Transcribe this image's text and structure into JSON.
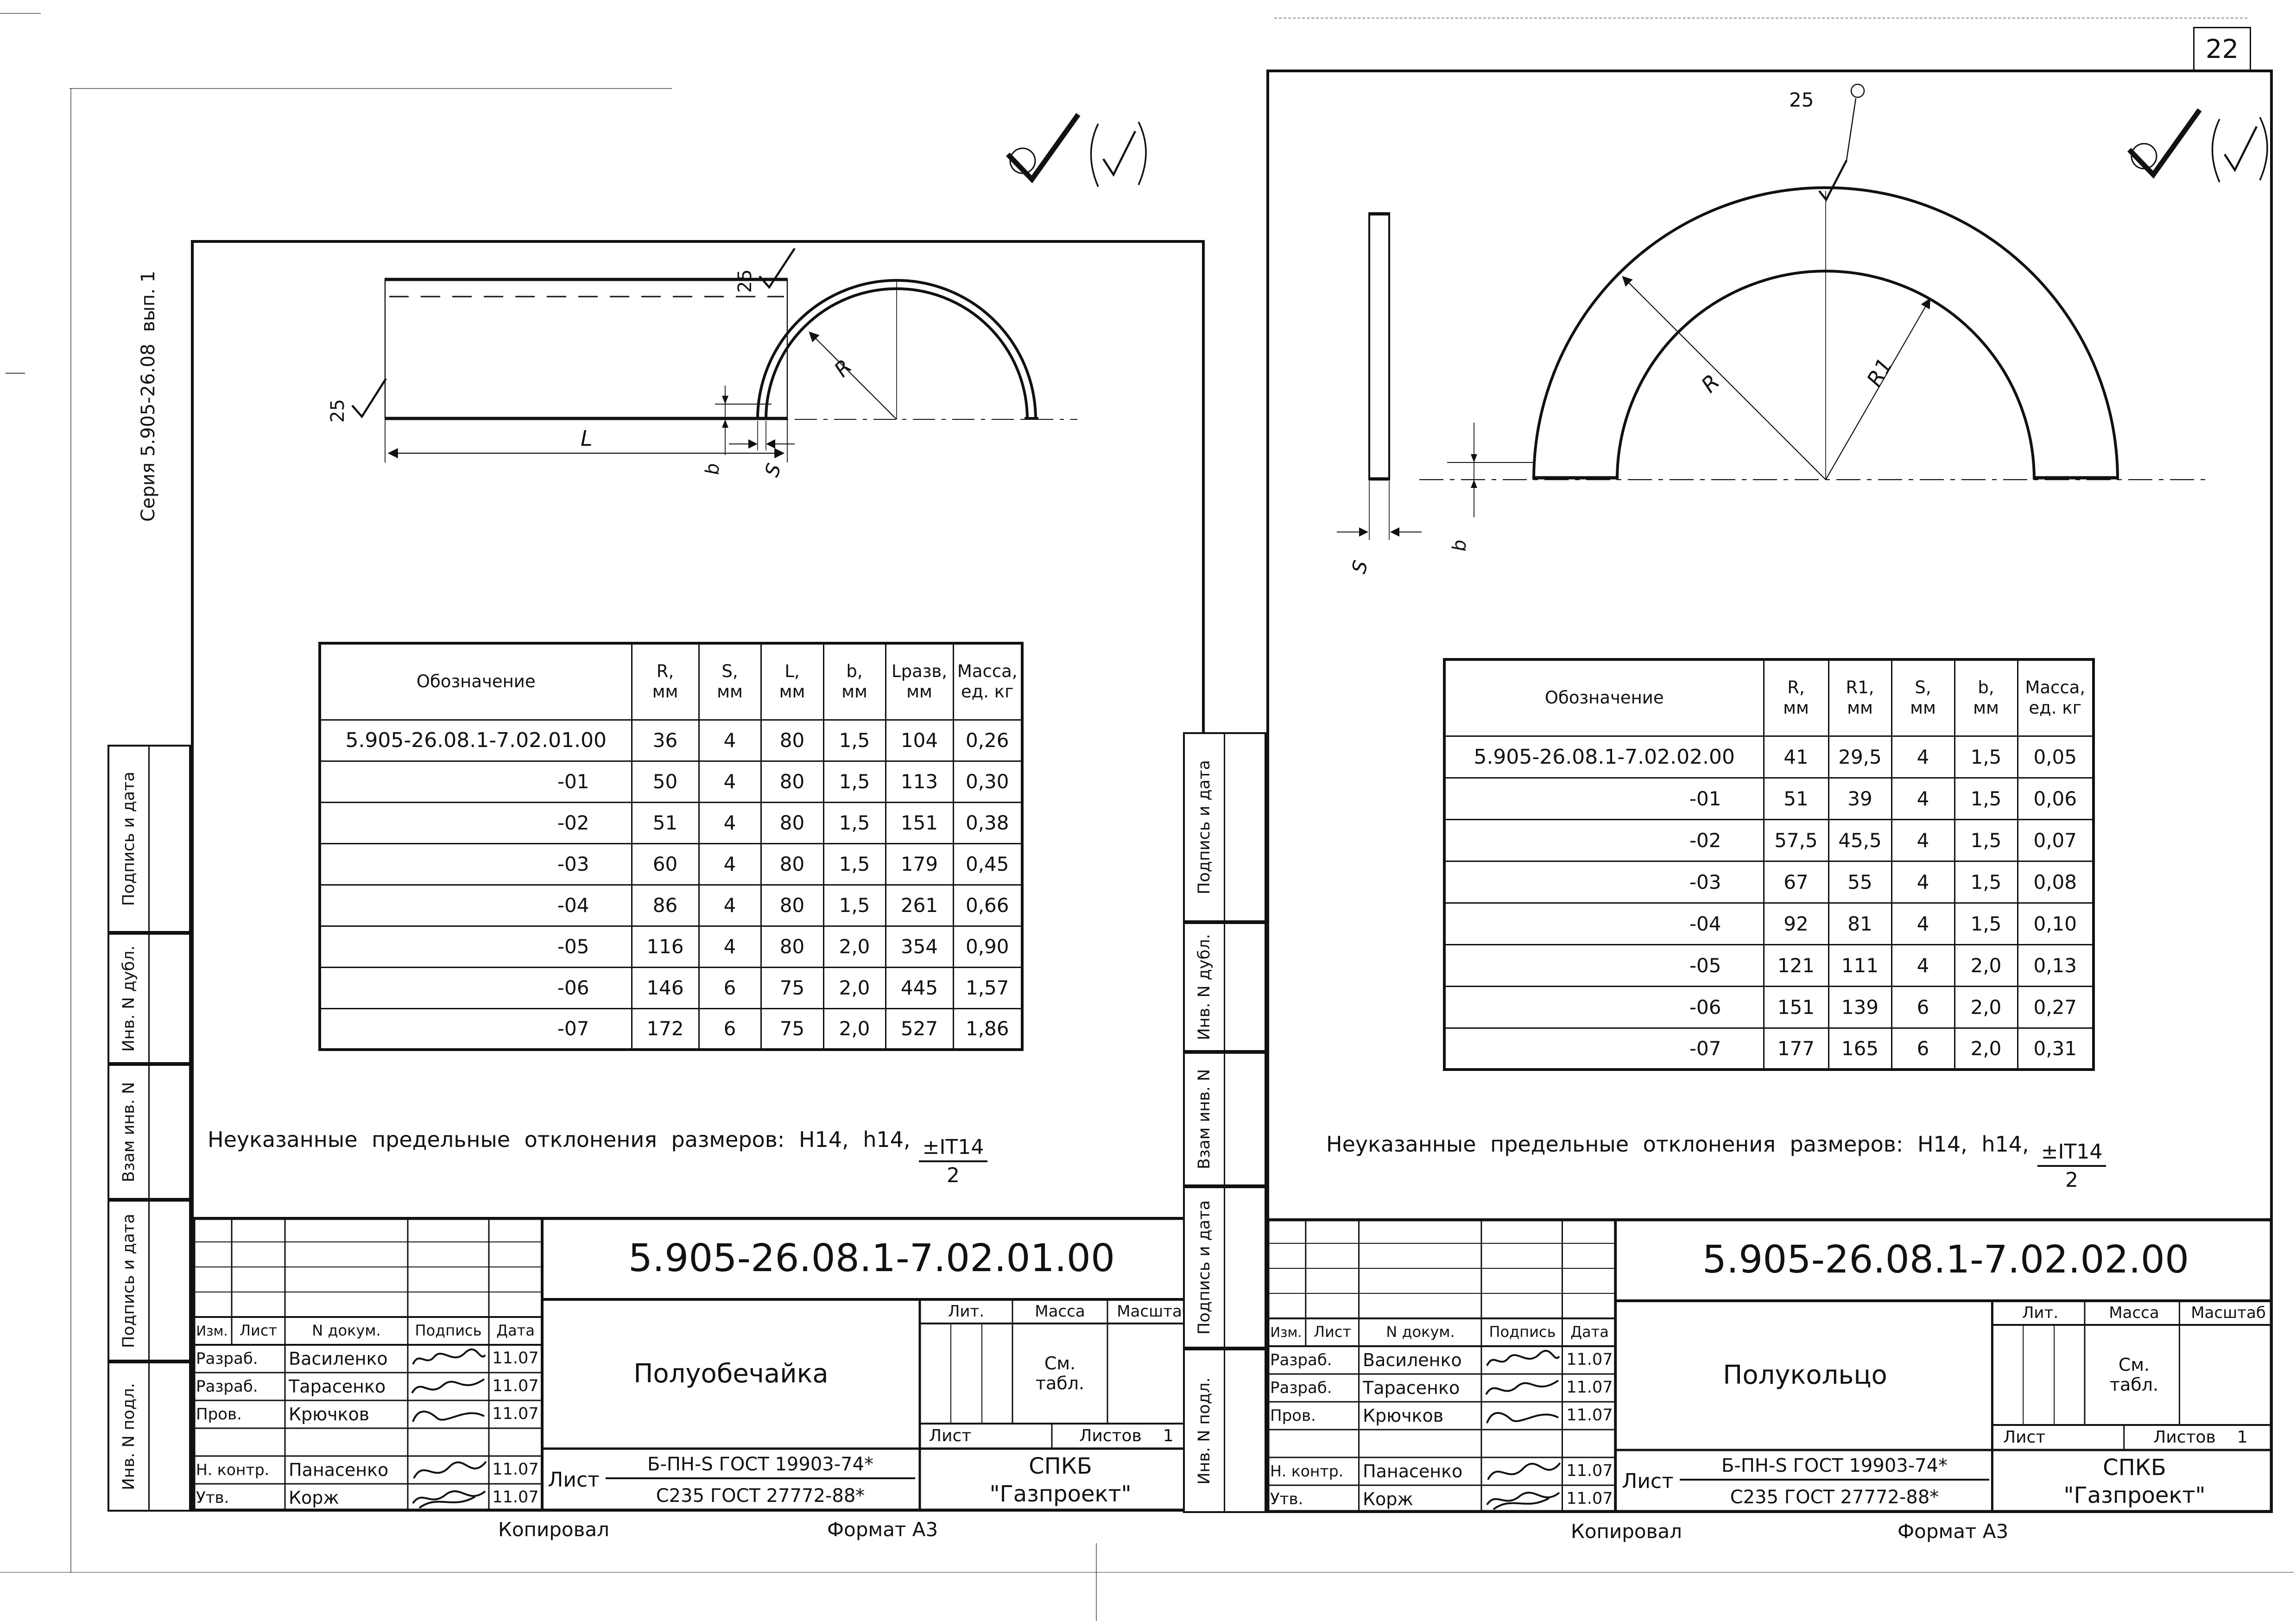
{
  "page": {
    "sheet_number": "22",
    "footer_kopiroval": "Копировал",
    "footer_format": "Формат А3"
  },
  "left_sheet": {
    "series_label": "Серия 5.905-26.08  вып. 1",
    "margin_labels": [
      "Подпись и дата",
      "Инв. N дубл.",
      "Взам инв. N",
      "Подпись и дата",
      "Инв. N подл."
    ],
    "drawing": {
      "rough_top": "25",
      "rough_left": "25",
      "dim_L": "L",
      "dim_R": "R",
      "dim_b": "b",
      "dim_S": "S"
    },
    "table": {
      "headers": [
        "Обозначение",
        "R,\nмм",
        "S,\nмм",
        "L,\nмм",
        "b,\nмм",
        "Lразв,\nмм",
        "Масса,\nед. кг"
      ],
      "rows": [
        [
          "5.905-26.08.1-7.02.01.00",
          "36",
          "4",
          "80",
          "1,5",
          "104",
          "0,26"
        ],
        [
          "-01",
          "50",
          "4",
          "80",
          "1,5",
          "113",
          "0,30"
        ],
        [
          "-02",
          "51",
          "4",
          "80",
          "1,5",
          "151",
          "0,38"
        ],
        [
          "-03",
          "60",
          "4",
          "80",
          "1,5",
          "179",
          "0,45"
        ],
        [
          "-04",
          "86",
          "4",
          "80",
          "1,5",
          "261",
          "0,66"
        ],
        [
          "-05",
          "116",
          "4",
          "80",
          "2,0",
          "354",
          "0,90"
        ],
        [
          "-06",
          "146",
          "6",
          "75",
          "2,0",
          "445",
          "1,57"
        ],
        [
          "-07",
          "172",
          "6",
          "75",
          "2,0",
          "527",
          "1,86"
        ]
      ]
    },
    "note": {
      "text": "Неуказанные предельные отклонения размеров: H14, h14,",
      "frac_num": "±IT14",
      "frac_den": "2"
    },
    "title_block": {
      "doc_number": "5.905-26.08.1-7.02.01.00",
      "part_name": "Полуобечайка",
      "col_izm": "Изм.",
      "col_list": "Лист",
      "col_dokum": "N докум.",
      "col_podpis": "Подпись",
      "col_data": "Дата",
      "people": [
        {
          "role": "Разраб.",
          "name": "Василенко",
          "date": "11.07"
        },
        {
          "role": "Разраб.",
          "name": "Тарасенко",
          "date": "11.07"
        },
        {
          "role": "Пров.",
          "name": "Крючков",
          "date": "11.07"
        },
        {
          "role": "",
          "name": "",
          "date": ""
        },
        {
          "role": "Н. контр.",
          "name": "Панасенко",
          "date": "11.07"
        },
        {
          "role": "Утв.",
          "name": "Корж",
          "date": "11.07"
        }
      ],
      "lit_label": "Лит.",
      "massa_label": "Масса",
      "masshtab_label": "Масштаб",
      "massa_value": "См.\nтабл.",
      "list_label": "Лист",
      "listov_label": "Листов",
      "listov_value": "1",
      "material_prefix": "Лист",
      "material_top": "Б-ПН-S ГОСТ 19903-74*",
      "material_bottom": "С235 ГОСТ 27772-88*",
      "org": "СПКБ\n\"Газпроект\""
    },
    "footer_kopiroval": "Копировал",
    "footer_format": "Формат А3"
  },
  "right_sheet": {
    "margin_labels": [
      "Подпись и дата",
      "Инв. N дубл.",
      "Взам инв. N",
      "Подпись и дата",
      "Инв. N подл."
    ],
    "drawing": {
      "rough_apex": "25",
      "dim_R": "R",
      "dim_R1": "R1",
      "dim_b": "b",
      "dim_S": "S"
    },
    "table": {
      "headers": [
        "Обозначение",
        "R,\nмм",
        "R1,\nмм",
        "S,\nмм",
        "b,\nмм",
        "Масса,\nед. кг"
      ],
      "rows": [
        [
          "5.905-26.08.1-7.02.02.00",
          "41",
          "29,5",
          "4",
          "1,5",
          "0,05"
        ],
        [
          "-01",
          "51",
          "39",
          "4",
          "1,5",
          "0,06"
        ],
        [
          "-02",
          "57,5",
          "45,5",
          "4",
          "1,5",
          "0,07"
        ],
        [
          "-03",
          "67",
          "55",
          "4",
          "1,5",
          "0,08"
        ],
        [
          "-04",
          "92",
          "81",
          "4",
          "1,5",
          "0,10"
        ],
        [
          "-05",
          "121",
          "111",
          "4",
          "2,0",
          "0,13"
        ],
        [
          "-06",
          "151",
          "139",
          "6",
          "2,0",
          "0,27"
        ],
        [
          "-07",
          "177",
          "165",
          "6",
          "2,0",
          "0,31"
        ]
      ]
    },
    "note": {
      "text": "Неуказанные предельные отклонения размеров: H14, h14,",
      "frac_num": "±IT14",
      "frac_den": "2"
    },
    "title_block": {
      "doc_number": "5.905-26.08.1-7.02.02.00",
      "part_name": "Полукольцо",
      "col_izm": "Изм.",
      "col_list": "Лист",
      "col_dokum": "N докум.",
      "col_podpis": "Подпись",
      "col_data": "Дата",
      "people": [
        {
          "role": "Разраб.",
          "name": "Василенко",
          "date": "11.07"
        },
        {
          "role": "Разраб.",
          "name": "Тарасенко",
          "date": "11.07"
        },
        {
          "role": "Пров.",
          "name": "Крючков",
          "date": "11.07"
        },
        {
          "role": "",
          "name": "",
          "date": ""
        },
        {
          "role": "Н. контр.",
          "name": "Панасенко",
          "date": "11.07"
        },
        {
          "role": "Утв.",
          "name": "Корж",
          "date": "11.07"
        }
      ],
      "lit_label": "Лит.",
      "massa_label": "Масса",
      "masshtab_label": "Масштаб",
      "massa_value": "См.\nтабл.",
      "list_label": "Лист",
      "listov_label": "Листов",
      "listov_value": "1",
      "material_prefix": "Лист",
      "material_top": "Б-ПН-S ГОСТ 19903-74*",
      "material_bottom": "С235 ГОСТ 27772-88*",
      "org": "СПКБ\n\"Газпроект\""
    },
    "footer_kopiroval": "Копировал",
    "footer_format": "Формат А3"
  }
}
